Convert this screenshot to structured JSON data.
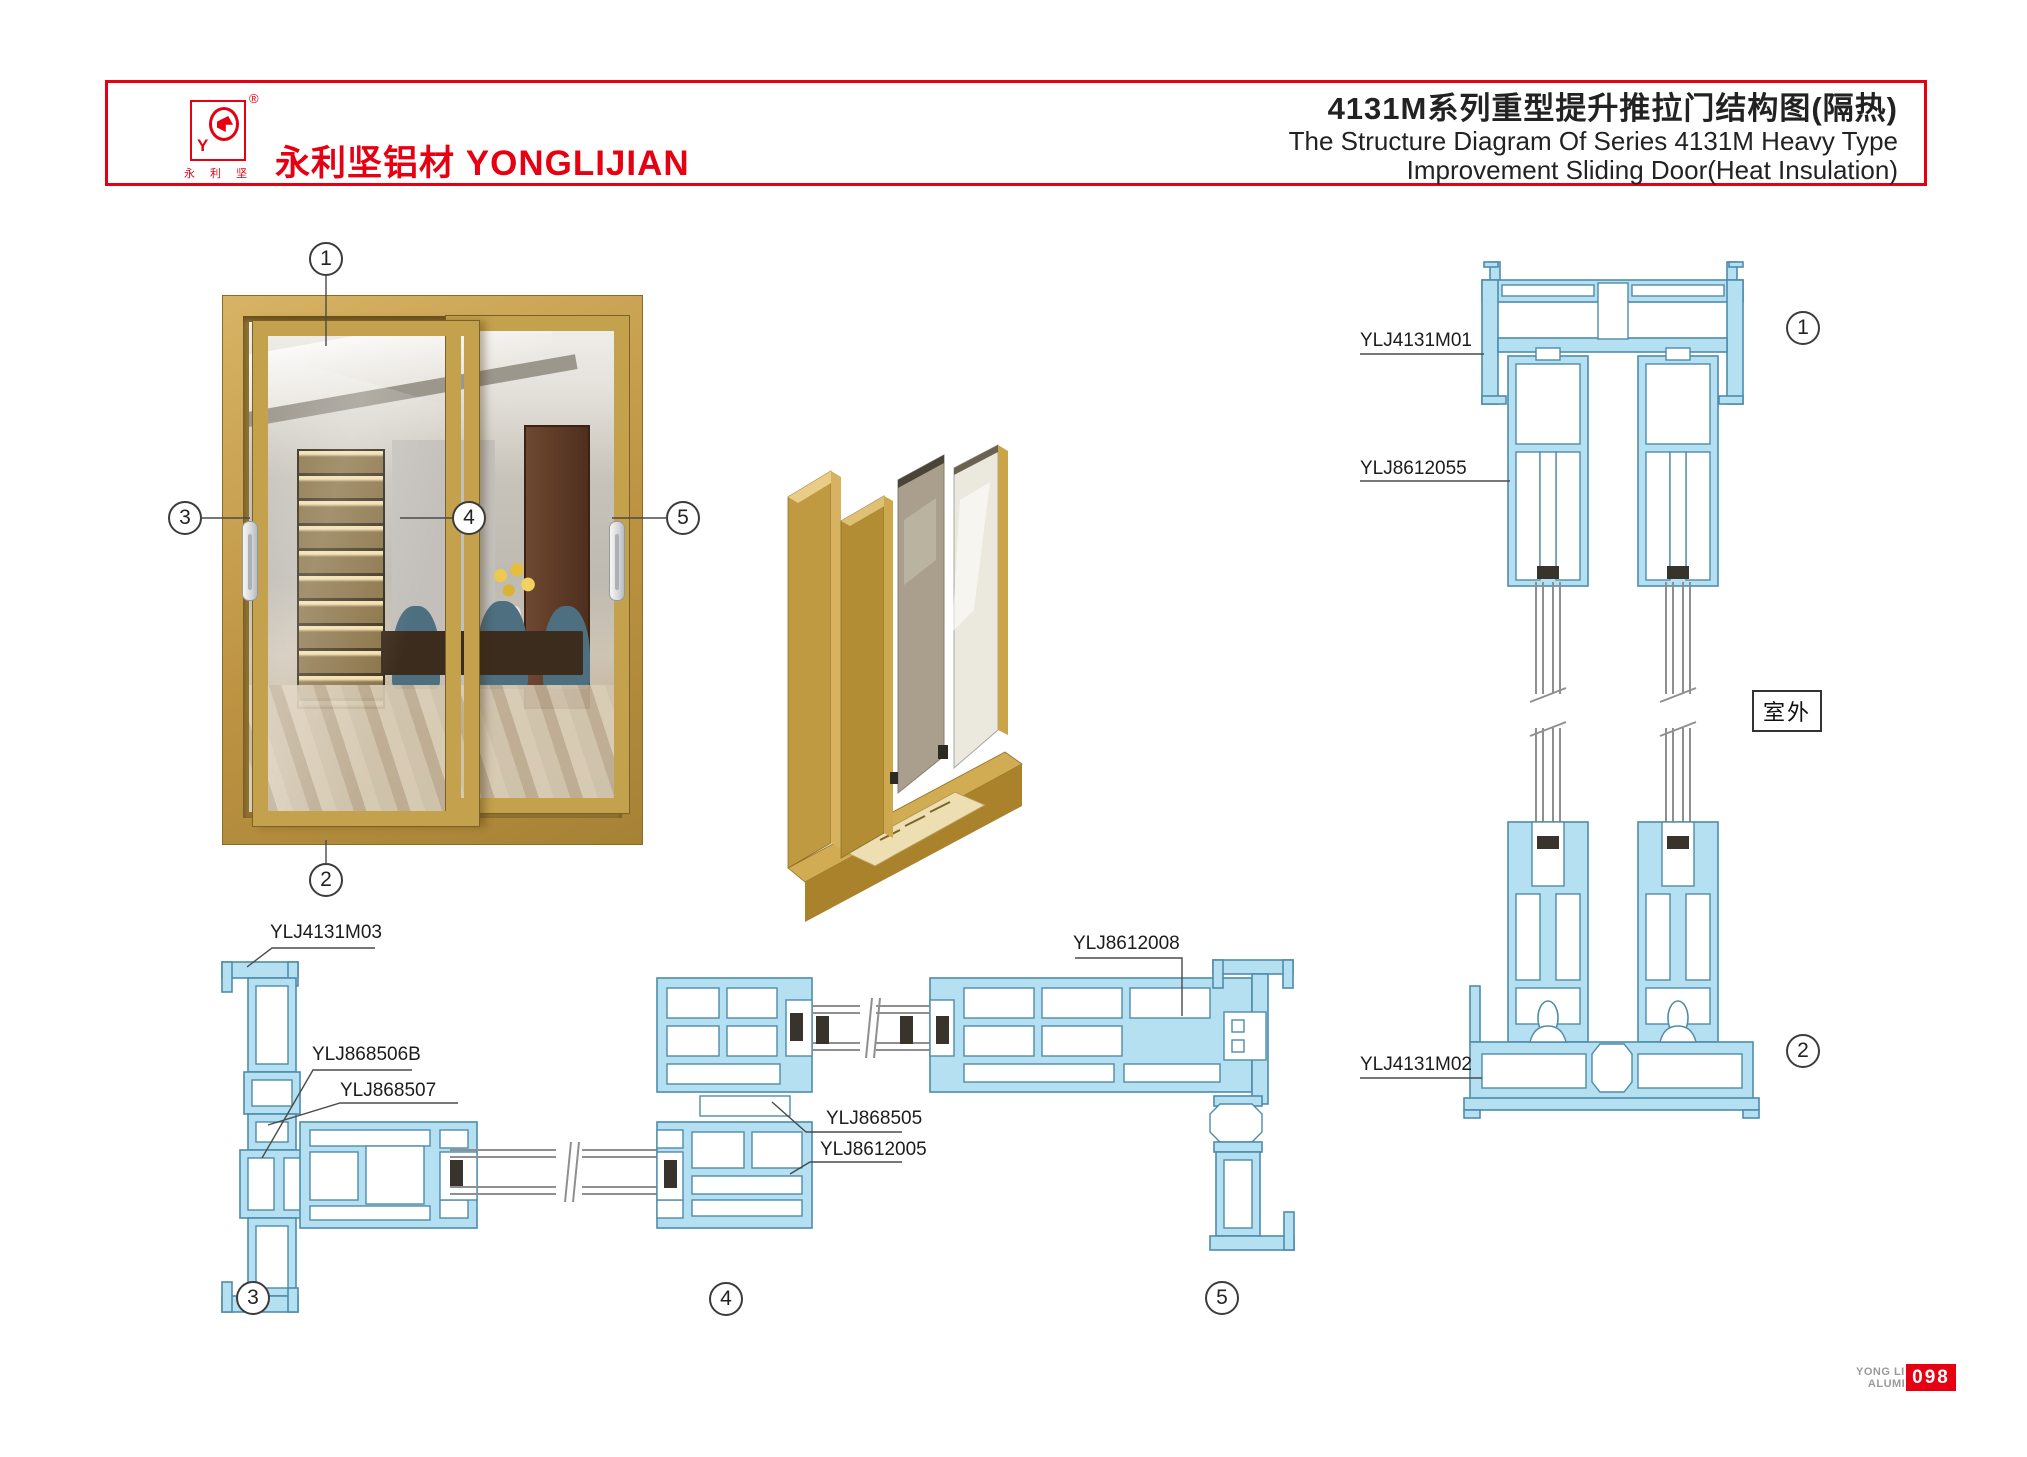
{
  "header": {
    "logo": {
      "monogram": "Y",
      "registered": "®",
      "caption": "永 利 坚",
      "brand_cn": "永利坚铝材",
      "brand_en": "YONGLIJIAN"
    },
    "title_cn": "4131M系列重型提升推拉门结构图(隔热)",
    "title_en1": "The Structure Diagram Of Series 4131M Heavy Type",
    "title_en2": "Improvement Sliding Door(Heat Insulation)"
  },
  "callouts": {
    "n1": "1",
    "n2": "2",
    "n3": "3",
    "n4": "4",
    "n5": "5"
  },
  "labels": {
    "jamb_profile": "YLJ4131M03",
    "corner_block": "YLJ868506B",
    "corner_cover": "YLJ868507",
    "interlock": "YLJ868505",
    "sash_profile": "YLJ8612005",
    "lock_stile": "YLJ8612008",
    "head_frame": "YLJ4131M01",
    "sash_vertical": "YLJ8612055",
    "sill_frame": "YLJ4131M02",
    "outdoor": "室外"
  },
  "footer": {
    "company_top": "YONG LI JIAN",
    "company_bottom": "ALUMINIUM",
    "page_number": "098"
  }
}
